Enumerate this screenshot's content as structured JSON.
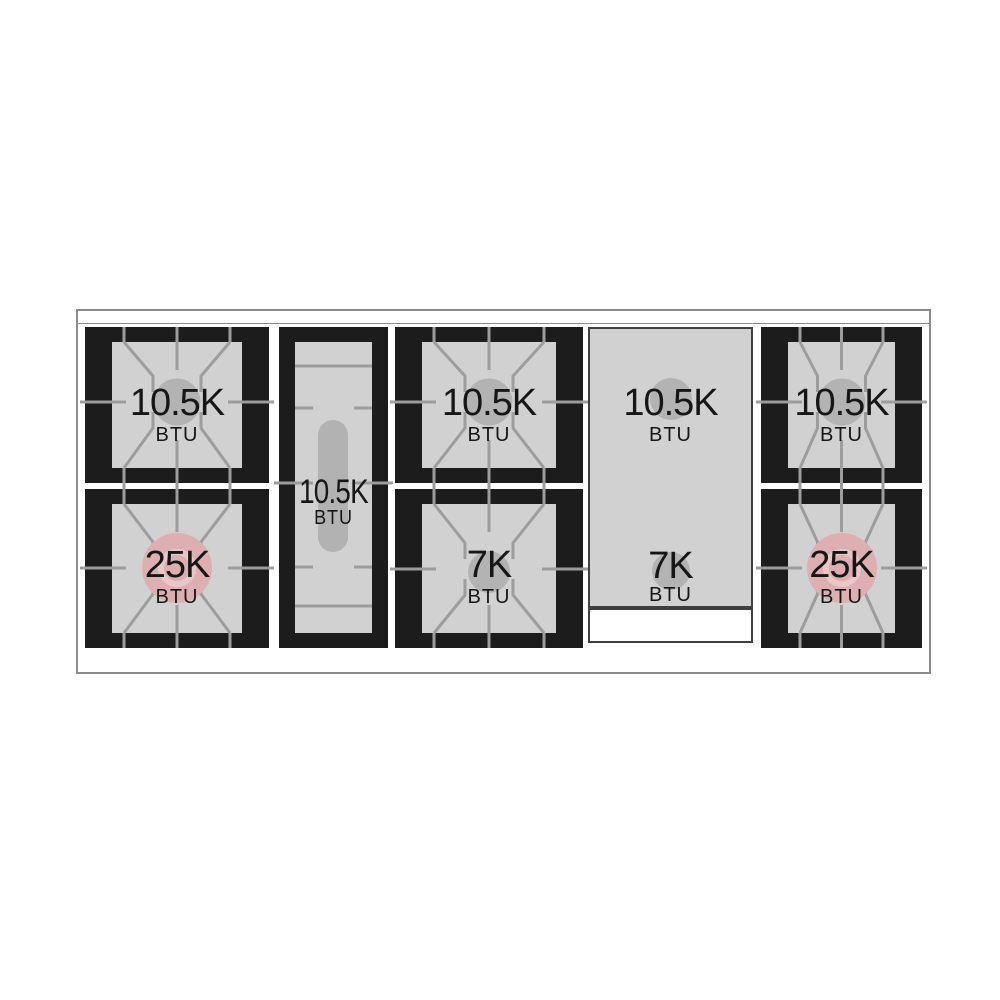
{
  "burners": {
    "left_top": {
      "value": "10.5K",
      "unit": "BTU"
    },
    "left_bottom": {
      "value": "25K",
      "unit": "BTU"
    },
    "center_oval": {
      "value": "10.5K",
      "unit": "BTU"
    },
    "middle_top": {
      "value": "10.5K",
      "unit": "BTU"
    },
    "middle_bottom": {
      "value": "7K",
      "unit": "BTU"
    },
    "griddle_top": {
      "value": "10.5K",
      "unit": "BTU"
    },
    "griddle_bottom": {
      "value": "7K",
      "unit": "BTU"
    },
    "right_top": {
      "value": "10.5K",
      "unit": "BTU"
    },
    "right_bottom": {
      "value": "25K",
      "unit": "BTU"
    }
  },
  "colors": {
    "frame_black": "#1c1c1c",
    "surface_gray": "#d1d1d1",
    "grate_line_gray": "#9d9d9d",
    "burner_gray": "#b3b3b3",
    "high_btu_pink": "#dcaeb1",
    "outline_gray": "#8a8a8a"
  }
}
